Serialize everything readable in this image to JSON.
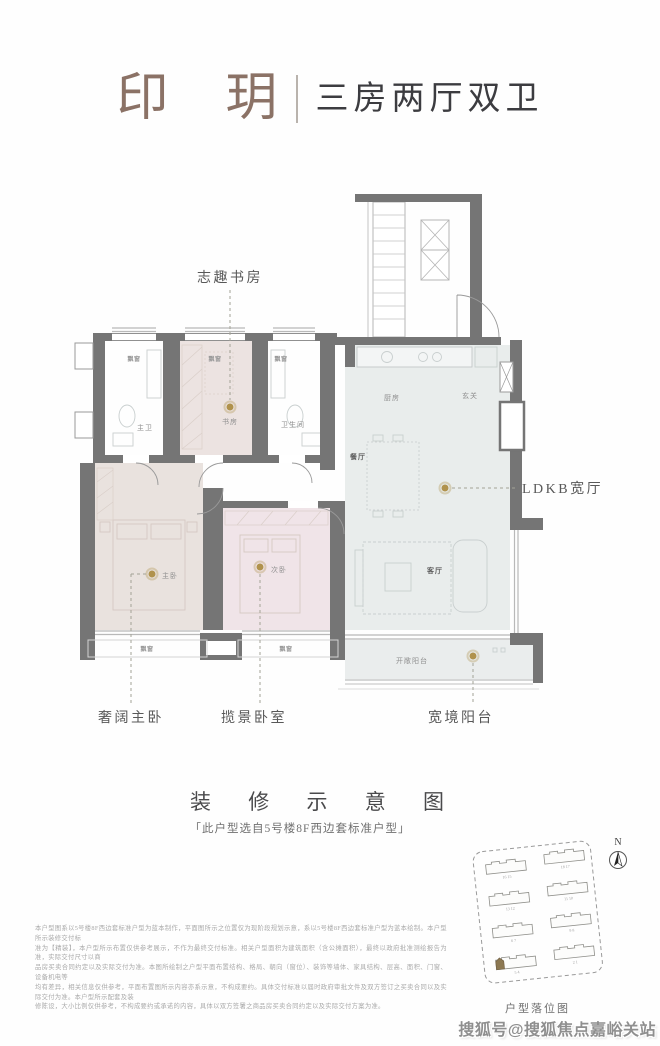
{
  "header": {
    "name": "印 玥",
    "tagline": "三房两厅双卫"
  },
  "plan": {
    "bay_window": "飘窗",
    "rooms": {
      "master_bath": "主卫",
      "study": "书房",
      "bath": "卫生间",
      "kitchen": "厨房",
      "foyer": "玄关",
      "dining": "餐厅",
      "living": "客厅",
      "balcony": "开敞阳台",
      "master_bed": "主卧",
      "second_bed": "次卧"
    },
    "callouts": {
      "study": "志趣书房",
      "ldkb": "LDKB宽厅",
      "master": "奢阔主卧",
      "second": "揽景卧室",
      "balcony": "宽境阳台"
    }
  },
  "caption": {
    "title": "装 修 示 意 图",
    "note": "「此户型选自5号楼8F西边套标准户型」"
  },
  "disclaimer": {
    "lines": [
      "本户型图系以5号楼8F西边套标准户型为蓝本制作，平面图所示之位置仅为现阶段规划示意，系以5号楼8F西边套标准户型为蓝本绘制。本户型所示装修交付标",
      "准为【精装】，本户型所示布置仅供参考展示，不作为最终交付标准。相关户型面积为建筑面积（含公摊面积），最终以政府批准测绘报告为准，实际交付尺寸以商",
      "品房买卖合同约定以及实际交付为准。本图所绘制之户型平面布置结构、格局、朝向（窗位）、装饰等墙体、家具结构、层高、面积、门窗、设备机电等",
      "均有差异，相关信息仅供参考，平面布置图所示内容亦系示意，不构成要约。具体交付标准以届时政府审批文件及双方签订之买卖合同以及实际交付为准。本户型所示配套及装",
      "修陈设，大小比例仅供参考，不构成要约或承诺的内容，具体以双方签署之商品房买卖合同约定以及实际交付方案为准。"
    ]
  },
  "siteplan": {
    "compass": "N",
    "label": "户型落位图",
    "building_numbers": [
      "16 15",
      "18 17",
      "13 12",
      "11 10",
      "6 7",
      "9 8",
      "5 4",
      "2 1"
    ]
  },
  "watermark": "搜狐号@搜狐焦点嘉峪关站",
  "colors": {
    "accent_gold": "#b0924c",
    "wall_gray": "#757575",
    "bedroom_fill": "#e9e2de",
    "second_bed_fill": "#f0e4e8",
    "study_fill": "#ece3e1",
    "living_fill": "#e9edec",
    "title_brown": "#8b7266",
    "highlight_unit": "#8c7852"
  }
}
